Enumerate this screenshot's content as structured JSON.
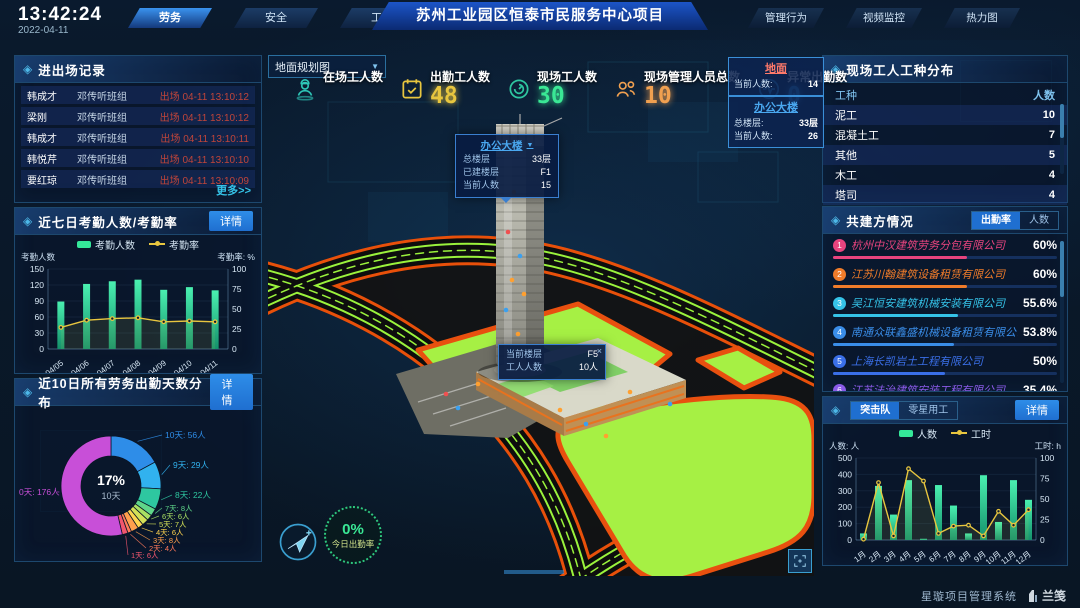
{
  "header": {
    "time": "13:42:24",
    "date": "2022-04-11",
    "left_tabs": [
      {
        "label": "劳务",
        "active": true
      },
      {
        "label": "安全",
        "active": false
      },
      {
        "label": "工期",
        "active": false
      }
    ],
    "title": "苏州工业园区恒泰市民服务中心项目",
    "right_tabs": [
      {
        "label": "管理行为"
      },
      {
        "label": "视频监控"
      },
      {
        "label": "热力图"
      }
    ]
  },
  "left": {
    "records": {
      "title": "进出场记录",
      "more": "更多>>",
      "rows": [
        {
          "name": "韩成才",
          "team": "邓传听班组",
          "event": "出场 04-11 13:10:12"
        },
        {
          "name": "梁刚",
          "team": "邓传听班组",
          "event": "出场 04-11 13:10:12"
        },
        {
          "name": "韩成才",
          "team": "邓传听班组",
          "event": "出场 04-11 13:10:11"
        },
        {
          "name": "韩悦芹",
          "team": "邓传听班组",
          "event": "出场 04-11 13:10:10"
        },
        {
          "name": "要红琼",
          "team": "邓传听班组",
          "event": "出场 04-11 13:10:09"
        }
      ]
    },
    "attendance": {
      "title": "近七日考勤人数/考勤率",
      "detail": "详情",
      "chart_data": {
        "type": "bar+line",
        "categories": [
          "04/05",
          "04/06",
          "04/07",
          "04/08",
          "04/09",
          "04/10",
          "04/11"
        ],
        "series": [
          {
            "name": "考勤人数",
            "type": "bar",
            "axis": "left",
            "color": "#35e89a",
            "values": [
              89,
              122,
              127,
              130,
              111,
              116,
              110
            ]
          },
          {
            "name": "考勤率",
            "type": "line",
            "axis": "right",
            "color": "#e8c63f",
            "values": [
              27,
              36,
              38,
              39,
              34,
              35,
              34
            ]
          }
        ],
        "ylabel": "考勤人数",
        "y2label": "考勤率: %",
        "ylim": [
          0,
          150
        ],
        "yticks": [
          0,
          30,
          60,
          90,
          120,
          150
        ],
        "y2lim": [
          0,
          100
        ],
        "y2ticks": [
          0,
          25,
          50,
          75,
          100
        ],
        "legend_position": "top"
      }
    },
    "distribution": {
      "title": "近10日所有劳务出勤天数分布",
      "detail": "详情",
      "chart_data": {
        "type": "donut",
        "unit": "人",
        "center_percent": "17%",
        "center_label": "10天",
        "slices": [
          {
            "label": "10天",
            "value": 56,
            "color": "#2e8de8"
          },
          {
            "label": "9天",
            "value": 29,
            "color": "#31b2ef"
          },
          {
            "label": "8天",
            "value": 22,
            "color": "#2ec7a0"
          },
          {
            "label": "7天",
            "value": 8,
            "color": "#5fd68a"
          },
          {
            "label": "6天",
            "value": 6,
            "color": "#a8e063"
          },
          {
            "label": "5天",
            "value": 7,
            "color": "#d4e157"
          },
          {
            "label": "4天",
            "value": 6,
            "color": "#ffd54f"
          },
          {
            "label": "3天",
            "value": 8,
            "color": "#ffa04d"
          },
          {
            "label": "2天",
            "value": 4,
            "color": "#ff7a5a"
          },
          {
            "label": "1天",
            "value": 6,
            "color": "#f2566e"
          },
          {
            "label": "0天",
            "value": 176,
            "color": "#c84fd8"
          }
        ]
      }
    }
  },
  "center": {
    "plan_select": {
      "value": "地面规划图",
      "caret": "▼"
    },
    "stats": [
      {
        "label": "在场工人数",
        "value": "",
        "color": "#2ec7b8",
        "icon": "worker-icon"
      },
      {
        "label": "出勤工人数",
        "value": "48",
        "color": "#e8c63f",
        "icon": "calendar-icon"
      },
      {
        "label": "现场工人数",
        "value": "30",
        "color": "#3ae895",
        "icon": "gauge-icon"
      },
      {
        "label": "现场管理人员总数",
        "value": "10",
        "color": "#f0a050",
        "icon": "people-icon"
      },
      {
        "label": "异常出勤数",
        "value": "0",
        "color": "#35a0f0",
        "icon": "pulse-icon"
      }
    ],
    "info_boxes": [
      {
        "title": "地面",
        "title_color": "#ff7a6a",
        "rows": [
          {
            "label": "当前人数:",
            "value": "14"
          }
        ]
      },
      {
        "title": "办公大楼",
        "title_color": "#4aa8f0",
        "rows": [
          {
            "label": "总楼层:",
            "value": "33层"
          },
          {
            "label": "当前人数:",
            "value": "26"
          }
        ]
      }
    ],
    "building_tooltip": {
      "title": "办公大楼",
      "caret": "▼",
      "rows": [
        {
          "label": "总楼层",
          "value": "33层"
        },
        {
          "label": "已建楼层",
          "value": "F1"
        },
        {
          "label": "当前人数",
          "value": "15"
        }
      ]
    },
    "floor_tooltip": {
      "close": "×",
      "rows": [
        {
          "label": "当前楼层",
          "value": "F5"
        },
        {
          "label": "工人人数",
          "value": "10人"
        }
      ]
    },
    "gauge": {
      "value": "0%",
      "label": "今日出勤率"
    }
  },
  "right": {
    "trades": {
      "title": "现场工人工种分布",
      "headers": [
        "工种",
        "人数"
      ],
      "rows": [
        [
          "泥工",
          "10"
        ],
        [
          "混凝土工",
          "7"
        ],
        [
          "其他",
          "5"
        ],
        [
          "木工",
          "4"
        ],
        [
          "塔司",
          "4"
        ]
      ]
    },
    "partners": {
      "title": "共建方情况",
      "tabs": [
        {
          "label": "出勤率",
          "active": true
        },
        {
          "label": "人数",
          "active": false
        }
      ],
      "items": [
        {
          "rank": "1",
          "name": "杭州中汉建筑劳务分包有限公司",
          "percent": "60%",
          "pct": 60,
          "color": "#e8447e"
        },
        {
          "rank": "2",
          "name": "江苏川翰建筑设备租赁有限公司",
          "percent": "60%",
          "pct": 60,
          "color": "#f07c2a"
        },
        {
          "rank": "3",
          "name": "吴江恒安建筑机械安装有限公司",
          "percent": "55.6%",
          "pct": 55.6,
          "color": "#35c3e8"
        },
        {
          "rank": "4",
          "name": "南通众联鑫盛机械设备租赁有限公司",
          "percent": "53.8%",
          "pct": 53.8,
          "color": "#3a8de8"
        },
        {
          "rank": "5",
          "name": "上海长凯岩土工程有限公司",
          "percent": "50%",
          "pct": 50,
          "color": "#3a6fe8"
        },
        {
          "rank": "6",
          "name": "江苏法治建筑安装工程有限公司",
          "percent": "35.4%",
          "pct": 35.4,
          "color": "#8a5ae8"
        }
      ]
    },
    "teams": {
      "tabs": [
        {
          "label": "突击队",
          "active": true
        },
        {
          "label": "零星用工",
          "active": false
        }
      ],
      "detail": "详情",
      "chart_data": {
        "type": "bar+line",
        "categories": [
          "1月",
          "2月",
          "3月",
          "4月",
          "5月",
          "6月",
          "7月",
          "8月",
          "9月",
          "10月",
          "11月",
          "12月"
        ],
        "series": [
          {
            "name": "人数",
            "type": "bar",
            "axis": "left",
            "color": "#35e89a",
            "values": [
              40,
              330,
              155,
              365,
              5,
              335,
              210,
              40,
              395,
              110,
              365,
              245
            ]
          },
          {
            "name": "工时",
            "type": "line",
            "axis": "right",
            "color": "#e8c63f",
            "values": [
              1,
              70,
              5,
              87,
              72,
              8,
              17,
              18,
              5,
              35,
              18,
              37
            ]
          }
        ],
        "ylabel": "人数: 人",
        "y2label": "工时: h",
        "ylim": [
          0,
          500
        ],
        "yticks": [
          0,
          100,
          200,
          300,
          400,
          500
        ],
        "y2lim": [
          0,
          100
        ],
        "y2ticks": [
          0,
          25,
          50,
          75,
          100
        ],
        "legend_position": "top"
      }
    }
  },
  "footer": {
    "system": "星璇项目管理系统",
    "logo": "兰笺"
  }
}
